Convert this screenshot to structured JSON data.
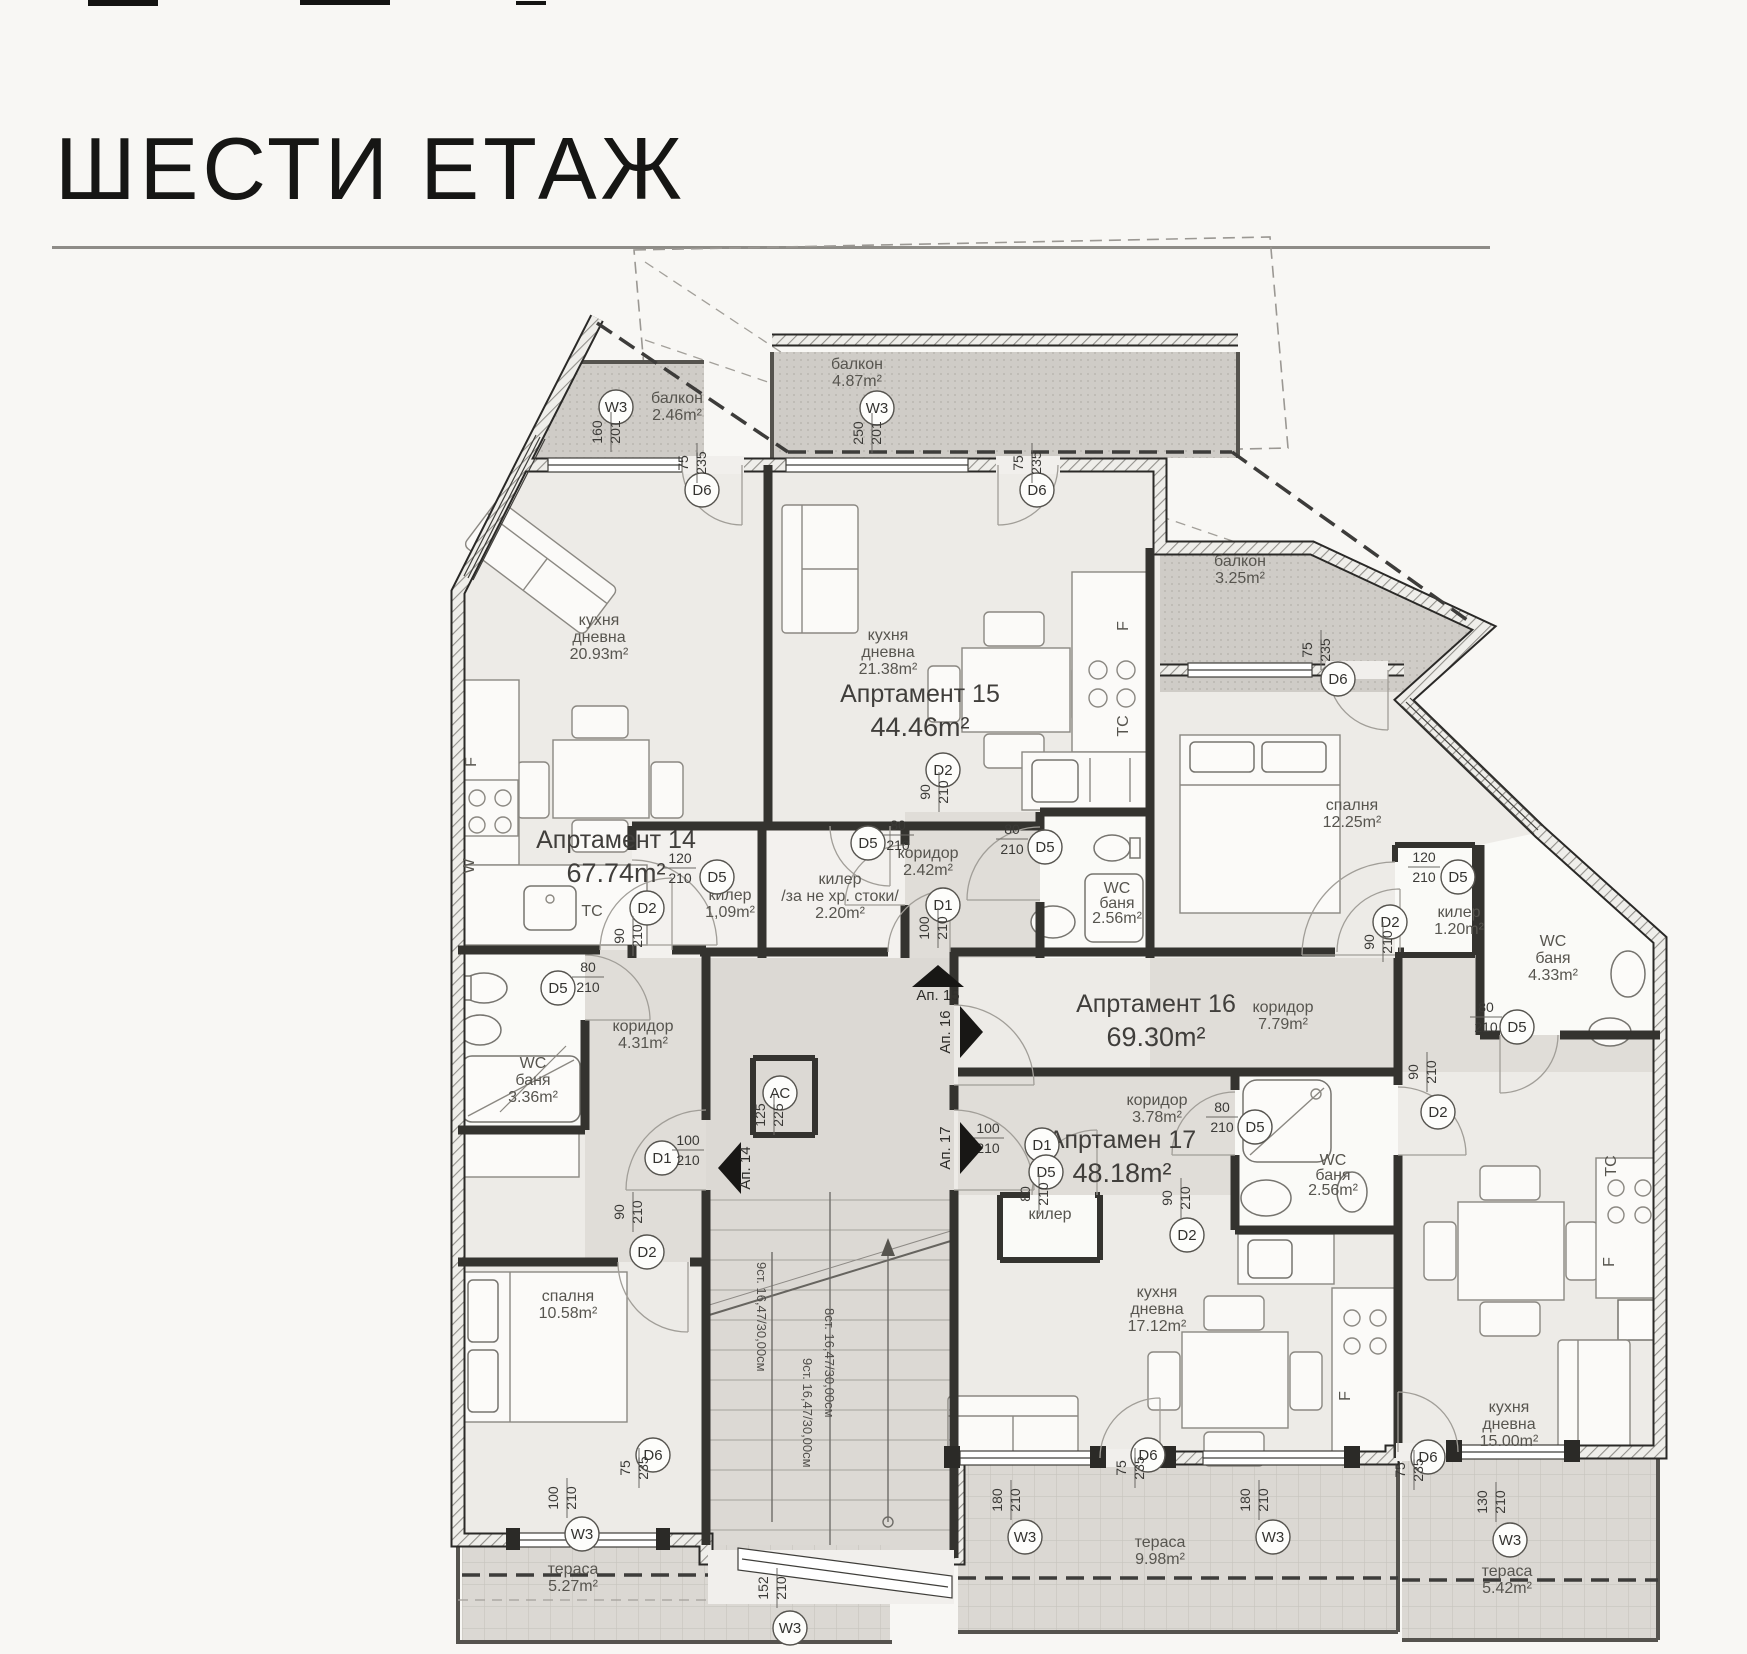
{
  "header": {
    "title": "ШЕСТИ ЕТАЖ"
  },
  "plan": {
    "apartments": [
      {
        "name": "Апртамент 14",
        "area": "67.74m²",
        "x": 616,
        "y": 848
      },
      {
        "name": "Апртамент 15",
        "area": "44.46m²",
        "x": 920,
        "y": 702
      },
      {
        "name": "Апртамент 16",
        "area": "69.30m²",
        "x": 1156,
        "y": 1012
      },
      {
        "name": "Апртамен 17",
        "area": "48.18m²",
        "x": 1122,
        "y": 1148
      }
    ],
    "rooms": [
      {
        "lines": [
          "кухня",
          "дневна",
          "20.93m²"
        ],
        "x": 599,
        "y": 625
      },
      {
        "lines": [
          "кухня",
          "дневна",
          "21.38m²"
        ],
        "x": 888,
        "y": 640
      },
      {
        "lines": [
          "кухня",
          "дневна",
          "17.12m²"
        ],
        "x": 1157,
        "y": 1297
      },
      {
        "lines": [
          "кухня",
          "дневна",
          "15.00m²"
        ],
        "x": 1509,
        "y": 1412
      },
      {
        "lines": [
          "спалня",
          "12.25m²"
        ],
        "x": 1352,
        "y": 810
      },
      {
        "lines": [
          "спалня",
          "10.58m²"
        ],
        "x": 568,
        "y": 1301
      },
      {
        "lines": [
          "коридор",
          "2.42m²"
        ],
        "x": 928,
        "y": 858
      },
      {
        "lines": [
          "коридор",
          "4.31m²"
        ],
        "x": 643,
        "y": 1031
      },
      {
        "lines": [
          "коридор",
          "7.79m²"
        ],
        "x": 1283,
        "y": 1012
      },
      {
        "lines": [
          "коридор",
          "3.78m²"
        ],
        "x": 1157,
        "y": 1105
      },
      {
        "lines": [
          "килер",
          "1,09m²"
        ],
        "x": 730,
        "y": 900
      },
      {
        "lines": [
          "килер",
          "/за не хр. стоки/",
          "2.20m²"
        ],
        "x": 840,
        "y": 884,
        "fs": 15
      },
      {
        "lines": [
          "килер",
          "1.20m²"
        ],
        "x": 1459,
        "y": 917
      },
      {
        "lines": [
          "килер"
        ],
        "x": 1050,
        "y": 1219
      },
      {
        "lines": [
          "WC",
          "баня",
          "3.36m²"
        ],
        "x": 533,
        "y": 1068
      },
      {
        "lines": [
          "WC",
          "баня",
          "2.56m²"
        ],
        "x": 1117,
        "y": 893,
        "fs": 13,
        "lh": 15
      },
      {
        "lines": [
          "WC",
          "баня",
          "4.33m²"
        ],
        "x": 1553,
        "y": 946
      },
      {
        "lines": [
          "WC",
          "баня",
          "2.56m²"
        ],
        "x": 1333,
        "y": 1165,
        "fs": 13,
        "lh": 15
      },
      {
        "lines": [
          "балкон",
          "2.46m²"
        ],
        "x": 677,
        "y": 403
      },
      {
        "lines": [
          "балкон",
          "4.87m²"
        ],
        "x": 857,
        "y": 369
      },
      {
        "lines": [
          "балкон",
          "3.25m²"
        ],
        "x": 1240,
        "y": 566
      },
      {
        "lines": [
          "тераса",
          "5.27m²"
        ],
        "x": 573,
        "y": 1574
      },
      {
        "lines": [
          "тераса",
          "9.98m²"
        ],
        "x": 1160,
        "y": 1547
      },
      {
        "lines": [
          "тераса",
          "5.42m²"
        ],
        "x": 1507,
        "y": 1576
      },
      {
        "lines": [
          "F"
        ],
        "x": 476,
        "y": 762,
        "rot": -90,
        "fs": 14
      },
      {
        "lines": [
          "W"
        ],
        "x": 474,
        "y": 866,
        "rot": -90,
        "fs": 14
      },
      {
        "lines": [
          "ТС"
        ],
        "x": 592,
        "y": 916,
        "fs": 14
      },
      {
        "lines": [
          "F"
        ],
        "x": 1128,
        "y": 626,
        "rot": -90,
        "fs": 14
      },
      {
        "lines": [
          "ТС"
        ],
        "x": 1128,
        "y": 726,
        "rot": -90,
        "fs": 14
      },
      {
        "lines": [
          "ТС"
        ],
        "x": 1616,
        "y": 1166,
        "rot": -90,
        "fs": 14
      },
      {
        "lines": [
          "F"
        ],
        "x": 1614,
        "y": 1262,
        "rot": -90,
        "fs": 14
      },
      {
        "lines": [
          "F"
        ],
        "x": 1350,
        "y": 1396,
        "rot": -90,
        "fs": 14
      }
    ],
    "markers": [
      {
        "t": "D6",
        "x": 702,
        "y": 490,
        "d1": "75",
        "d2": "235",
        "dx": 688,
        "dy": 463,
        "rot": true
      },
      {
        "t": "D6",
        "x": 1037,
        "y": 490,
        "d1": "75",
        "d2": "235",
        "dx": 1023,
        "dy": 463,
        "rot": true
      },
      {
        "t": "W3",
        "x": 616,
        "y": 407,
        "d1": "160",
        "d2": "201",
        "dx": 602,
        "dy": 432,
        "rot": true
      },
      {
        "t": "W3",
        "x": 877,
        "y": 408,
        "d1": "250",
        "d2": "201",
        "dx": 863,
        "dy": 433,
        "rot": true
      },
      {
        "t": "D6",
        "x": 1338,
        "y": 679,
        "d1": "75",
        "d2": "235",
        "dx": 1312,
        "dy": 650,
        "rot": true
      },
      {
        "t": "D5",
        "x": 717,
        "y": 877,
        "d1": "120",
        "d2": "210",
        "dx": 664,
        "dy": 863,
        "rot": false
      },
      {
        "t": "D5",
        "x": 868,
        "y": 843,
        "d1": "80",
        "d2": "210",
        "dx": 882,
        "dy": 830,
        "rot": false
      },
      {
        "t": "D5",
        "x": 1045,
        "y": 847,
        "d1": "80",
        "d2": "210",
        "dx": 996,
        "dy": 834,
        "rot": false
      },
      {
        "t": "D2",
        "x": 943,
        "y": 770,
        "d1": "90",
        "d2": "210",
        "dx": 930,
        "dy": 792,
        "rot": true
      },
      {
        "t": "D1",
        "x": 943,
        "y": 905,
        "d1": "100",
        "d2": "210",
        "dx": 929,
        "dy": 928,
        "rot": true
      },
      {
        "t": "D1",
        "x": 662,
        "y": 1158,
        "d1": "100",
        "d2": "210",
        "dx": 672,
        "dy": 1145,
        "rot": false
      },
      {
        "t": "АС",
        "x": 780,
        "y": 1093,
        "d1": "125",
        "d2": "225",
        "dx": 765,
        "dy": 1115,
        "rot": true
      },
      {
        "t": "D1",
        "x": 1042,
        "y": 1145,
        "d1": "100",
        "d2": "210",
        "dx": 972,
        "dy": 1133,
        "rot": false
      },
      {
        "t": "D5",
        "x": 1046,
        "y": 1172,
        "d1": "80",
        "d2": "210",
        "dx": 1030,
        "dy": 1194,
        "rot": true
      },
      {
        "t": "D2",
        "x": 1187,
        "y": 1235,
        "d1": "90",
        "d2": "210",
        "dx": 1172,
        "dy": 1198,
        "rot": true
      },
      {
        "t": "D5",
        "x": 1255,
        "y": 1127,
        "d1": "80",
        "d2": "210",
        "dx": 1206,
        "dy": 1112,
        "rot": false
      },
      {
        "t": "D2",
        "x": 647,
        "y": 1252,
        "d1": "90",
        "d2": "210",
        "dx": 624,
        "dy": 1212,
        "rot": true
      },
      {
        "t": "D6",
        "x": 653,
        "y": 1455,
        "d1": "75",
        "d2": "235",
        "dx": 630,
        "dy": 1468,
        "rot": true
      },
      {
        "t": "W3",
        "x": 582,
        "y": 1534,
        "d1": "100",
        "d2": "210",
        "dx": 558,
        "dy": 1498,
        "rot": true
      },
      {
        "t": "D5",
        "x": 558,
        "y": 988,
        "d1": "80",
        "d2": "210",
        "dx": 572,
        "dy": 972,
        "rot": false
      },
      {
        "t": "D2",
        "x": 647,
        "y": 908,
        "d1": "90",
        "d2": "210",
        "dx": 624,
        "dy": 936,
        "rot": true
      },
      {
        "t": "D5",
        "x": 1458,
        "y": 877,
        "d1": "120",
        "d2": "210",
        "dx": 1408,
        "dy": 862,
        "rot": false
      },
      {
        "t": "D2",
        "x": 1438,
        "y": 1112,
        "d1": "90",
        "d2": "210",
        "dx": 1418,
        "dy": 1072,
        "rot": true
      },
      {
        "t": "D5",
        "x": 1517,
        "y": 1027,
        "d1": "80",
        "d2": "210",
        "dx": 1470,
        "dy": 1012,
        "rot": false
      },
      {
        "t": "D2",
        "x": 1390,
        "y": 922,
        "d1": "90",
        "d2": "210",
        "dx": 1374,
        "dy": 942,
        "rot": true
      },
      {
        "t": "D6",
        "x": 1148,
        "y": 1455,
        "d1": "75",
        "d2": "235",
        "dx": 1126,
        "dy": 1468,
        "rot": true
      },
      {
        "t": "W3",
        "x": 1025,
        "y": 1537,
        "d1": "180",
        "d2": "210",
        "dx": 1002,
        "dy": 1500,
        "rot": true
      },
      {
        "t": "W3",
        "x": 1273,
        "y": 1537,
        "d1": "180",
        "d2": "210",
        "dx": 1250,
        "dy": 1500,
        "rot": true
      },
      {
        "t": "W3",
        "x": 1510,
        "y": 1540,
        "d1": "130",
        "d2": "210",
        "dx": 1487,
        "dy": 1502,
        "rot": true
      },
      {
        "t": "D6",
        "x": 1428,
        "y": 1457,
        "d1": "75",
        "d2": "235",
        "dx": 1405,
        "dy": 1470,
        "rot": true
      },
      {
        "t": "W3",
        "x": 790,
        "y": 1628,
        "d1": "152",
        "d2": "210",
        "dx": 768,
        "dy": 1588,
        "rot": true
      }
    ],
    "arrows": [
      {
        "label": "Ап. 15",
        "x": 938,
        "y": 977,
        "dir": "up",
        "lx": 938,
        "ly": 1000,
        "rot": 0
      },
      {
        "label": "Ап. 16",
        "x": 970,
        "y": 1032,
        "dir": "right",
        "lx": 950,
        "ly": 1032,
        "rot": -90
      },
      {
        "label": "Ап. 17",
        "x": 970,
        "y": 1148,
        "dir": "right",
        "lx": 950,
        "ly": 1148,
        "rot": -90
      },
      {
        "label": "Ап. 14",
        "x": 731,
        "y": 1168,
        "dir": "left",
        "lx": 750,
        "ly": 1168,
        "rot": -90
      }
    ],
    "stairs": [
      {
        "text": "9ст. 16,47/30,00см",
        "x": 757,
        "y": 1262
      },
      {
        "text": "8ст. 16,47/30,00см",
        "x": 825,
        "y": 1308
      },
      {
        "text": "9ст. 16,47/30,00см",
        "x": 803,
        "y": 1358
      }
    ]
  }
}
